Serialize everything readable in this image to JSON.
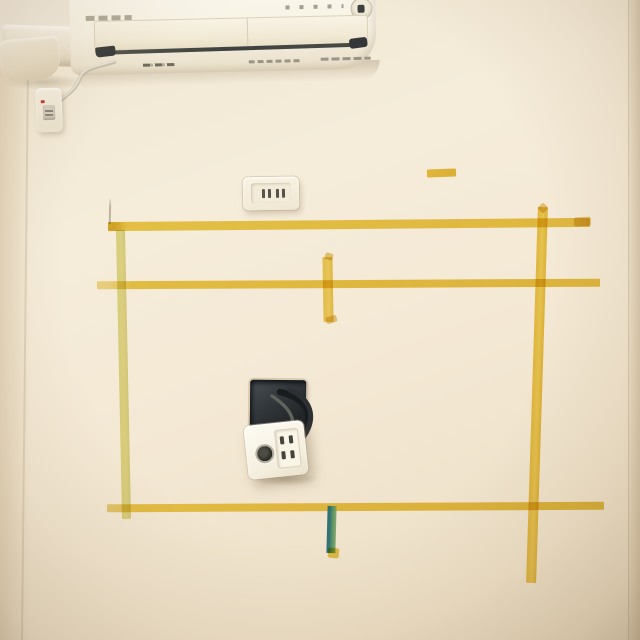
{
  "photo": {
    "subject": "room wall with wall-mounted air conditioner, piping duct, two power outlets, an opened wall box with cables, and masking-tape layout marks",
    "labels": {
      "scene": "wall photo",
      "ac": "air conditioner",
      "duct": "piping cover duct",
      "wall_plate": "small wall plate",
      "outlet": "duplex wall outlet",
      "hole": "opened wall box with cables",
      "hanging_plate": "hanging outlet plate",
      "tape": "masking tape mark"
    },
    "colors": {
      "wall": "#f3e9d6",
      "wall_shadow": "#e7dac2",
      "ac_body": "#f8f4e8",
      "ac_vent_dark": "#3e4240",
      "tape_yellow": "#e8c23e",
      "tape_pale_yellow": "#dedc84",
      "tape_green": "#48885e",
      "tape_green_edge": "#286c70",
      "hole_dark": "#24282b",
      "cable_black": "#1b1e20",
      "plate_white": "#fbf8ef",
      "slot_dark": "#4c4a42",
      "red_mark": "#c23b2e"
    }
  }
}
